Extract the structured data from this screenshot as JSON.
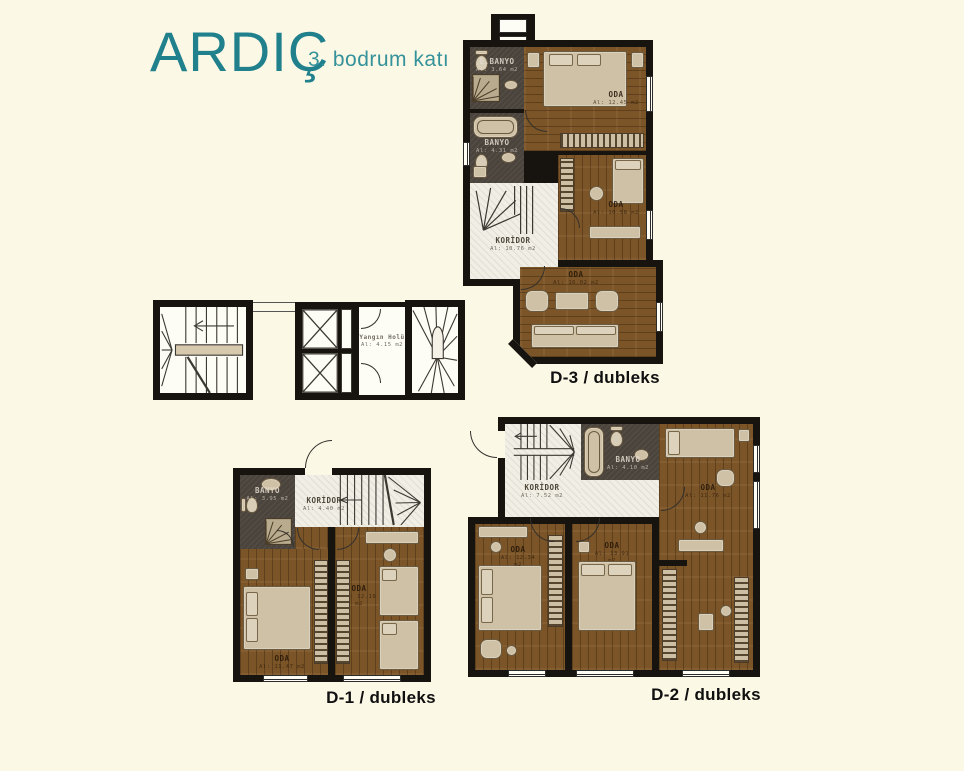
{
  "header": {
    "title": "ARDIÇ",
    "subtitle": "3. bodrum katı"
  },
  "colors": {
    "accent": "#20818d",
    "background": "#fcf8e6",
    "wall": "#17130e",
    "wood": "#7b5427",
    "bath": "#4b443c",
    "tile": "#f0eee5",
    "furniture": "#cfc1a5"
  },
  "core": {
    "fire_hall": {
      "name": "Yangın Holü",
      "area": "Al: 4.15 m2"
    }
  },
  "plans": {
    "d3": {
      "label": "D-3 / dubleks",
      "rooms": {
        "bedroom_top": {
          "name": "ODA",
          "area": "Al: 12.45 m2"
        },
        "bedroom_mid": {
          "name": "ODA",
          "area": "Al: 10.58 m2"
        },
        "living": {
          "name": "ODA",
          "area": "Al: 16.02 m2"
        },
        "koridor": {
          "name": "KORİDOR",
          "area": "Al: 10.76 m2"
        },
        "ebanyo": {
          "name": "E.BANYO",
          "area": "Al: 3.64 m2"
        },
        "banyo": {
          "name": "BANYO",
          "area": "Al: 4.31 m2"
        }
      }
    },
    "d1": {
      "label": "D-1 / dubleks",
      "rooms": {
        "koridor": {
          "name": "KORİDOR",
          "area": "Al: 4.40 m2"
        },
        "banyo": {
          "name": "BANYO",
          "area": "Al: 3.95 m2"
        },
        "bedroom_left": {
          "name": "ODA",
          "area": "Al: 11.47 m2"
        },
        "bedroom_right": {
          "name": "ODA",
          "area": "Al: 12.19 m2"
        }
      }
    },
    "d2": {
      "label": "D-2 / dubleks",
      "rooms": {
        "koridor": {
          "name": "KORİDOR",
          "area": "Al: 7.52 m2"
        },
        "banyo": {
          "name": "BANYO",
          "area": "Al: 4.10 m2"
        },
        "bedroom_right": {
          "name": "ODA",
          "area": "Al: 11.76 m2"
        },
        "bedroom_left": {
          "name": "ODA",
          "area": "Al: 12.34 m2"
        },
        "bedroom_mid": {
          "name": "ODA",
          "area": "Al: 13.91 m2"
        }
      }
    }
  }
}
